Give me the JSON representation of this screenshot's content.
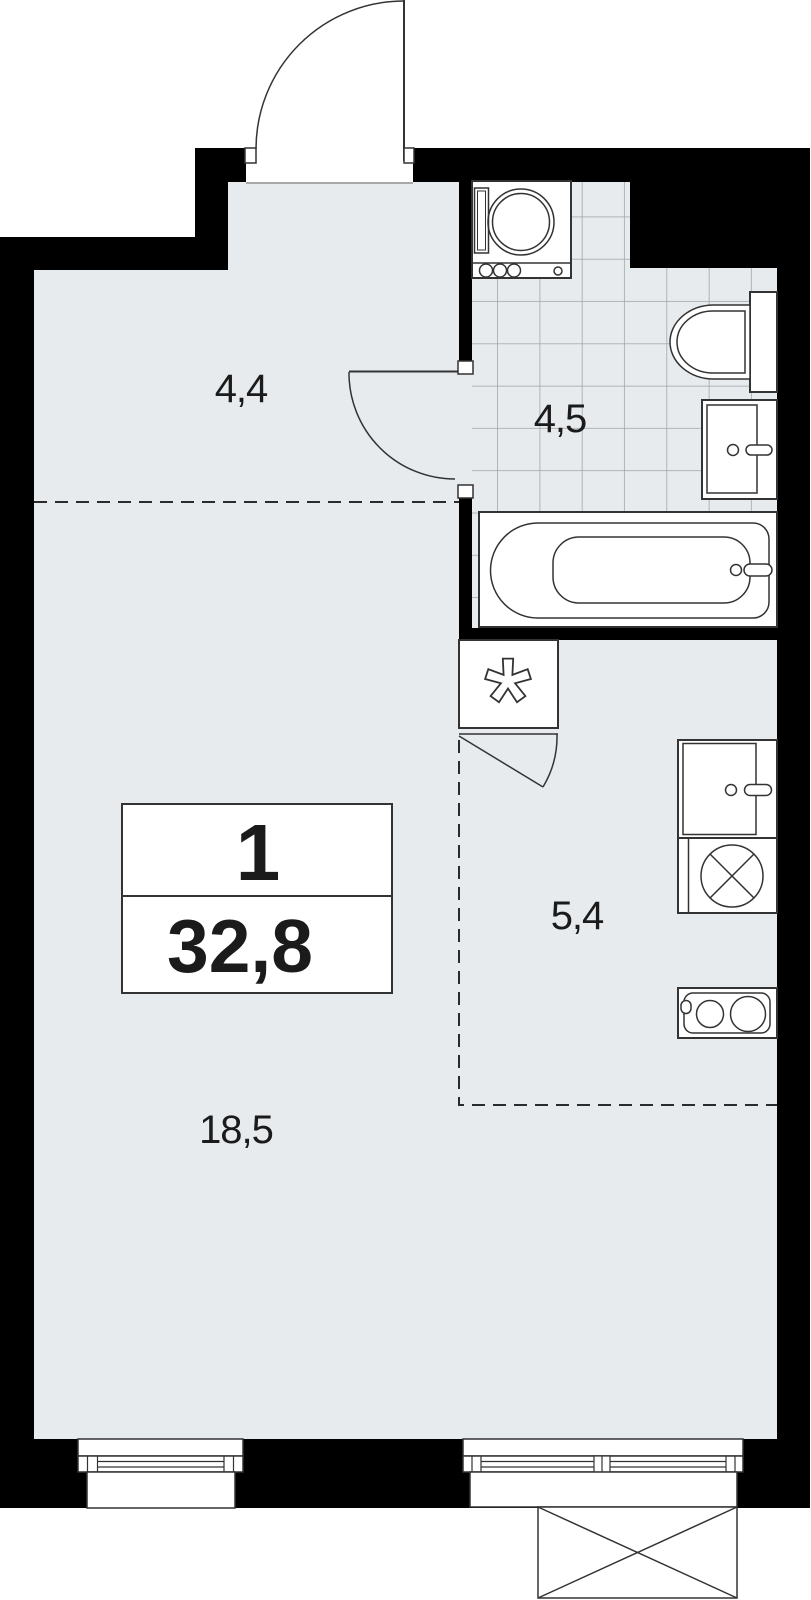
{
  "plan": {
    "unit_summary": {
      "rooms_count": "1",
      "total_area": "32,8"
    },
    "rooms": [
      {
        "name": "hallway",
        "area": "4,4"
      },
      {
        "name": "bathroom",
        "area": "4,5"
      },
      {
        "name": "kitchen-niche",
        "area": "5,4"
      },
      {
        "name": "living-room",
        "area": "18,5"
      }
    ],
    "fixtures": [
      "washing-machine",
      "toilet",
      "washbasin",
      "bathtub",
      "ventilation-shaft",
      "closet-door",
      "kitchen-sink",
      "cooktop",
      "two-burner-stove",
      "entrance-door",
      "bathroom-door",
      "window-left",
      "window-right",
      "balcony-marker"
    ],
    "markers": {
      "ventilation_symbol": "asterisk",
      "balcony_marker": "crossed-box"
    },
    "colors": {
      "wall": "#000000",
      "floor": "#e8ebee",
      "tile_line": "#9ca2a8",
      "outline": "#333333",
      "label_text": "#1b1b1b",
      "background": "#ffffff"
    }
  }
}
